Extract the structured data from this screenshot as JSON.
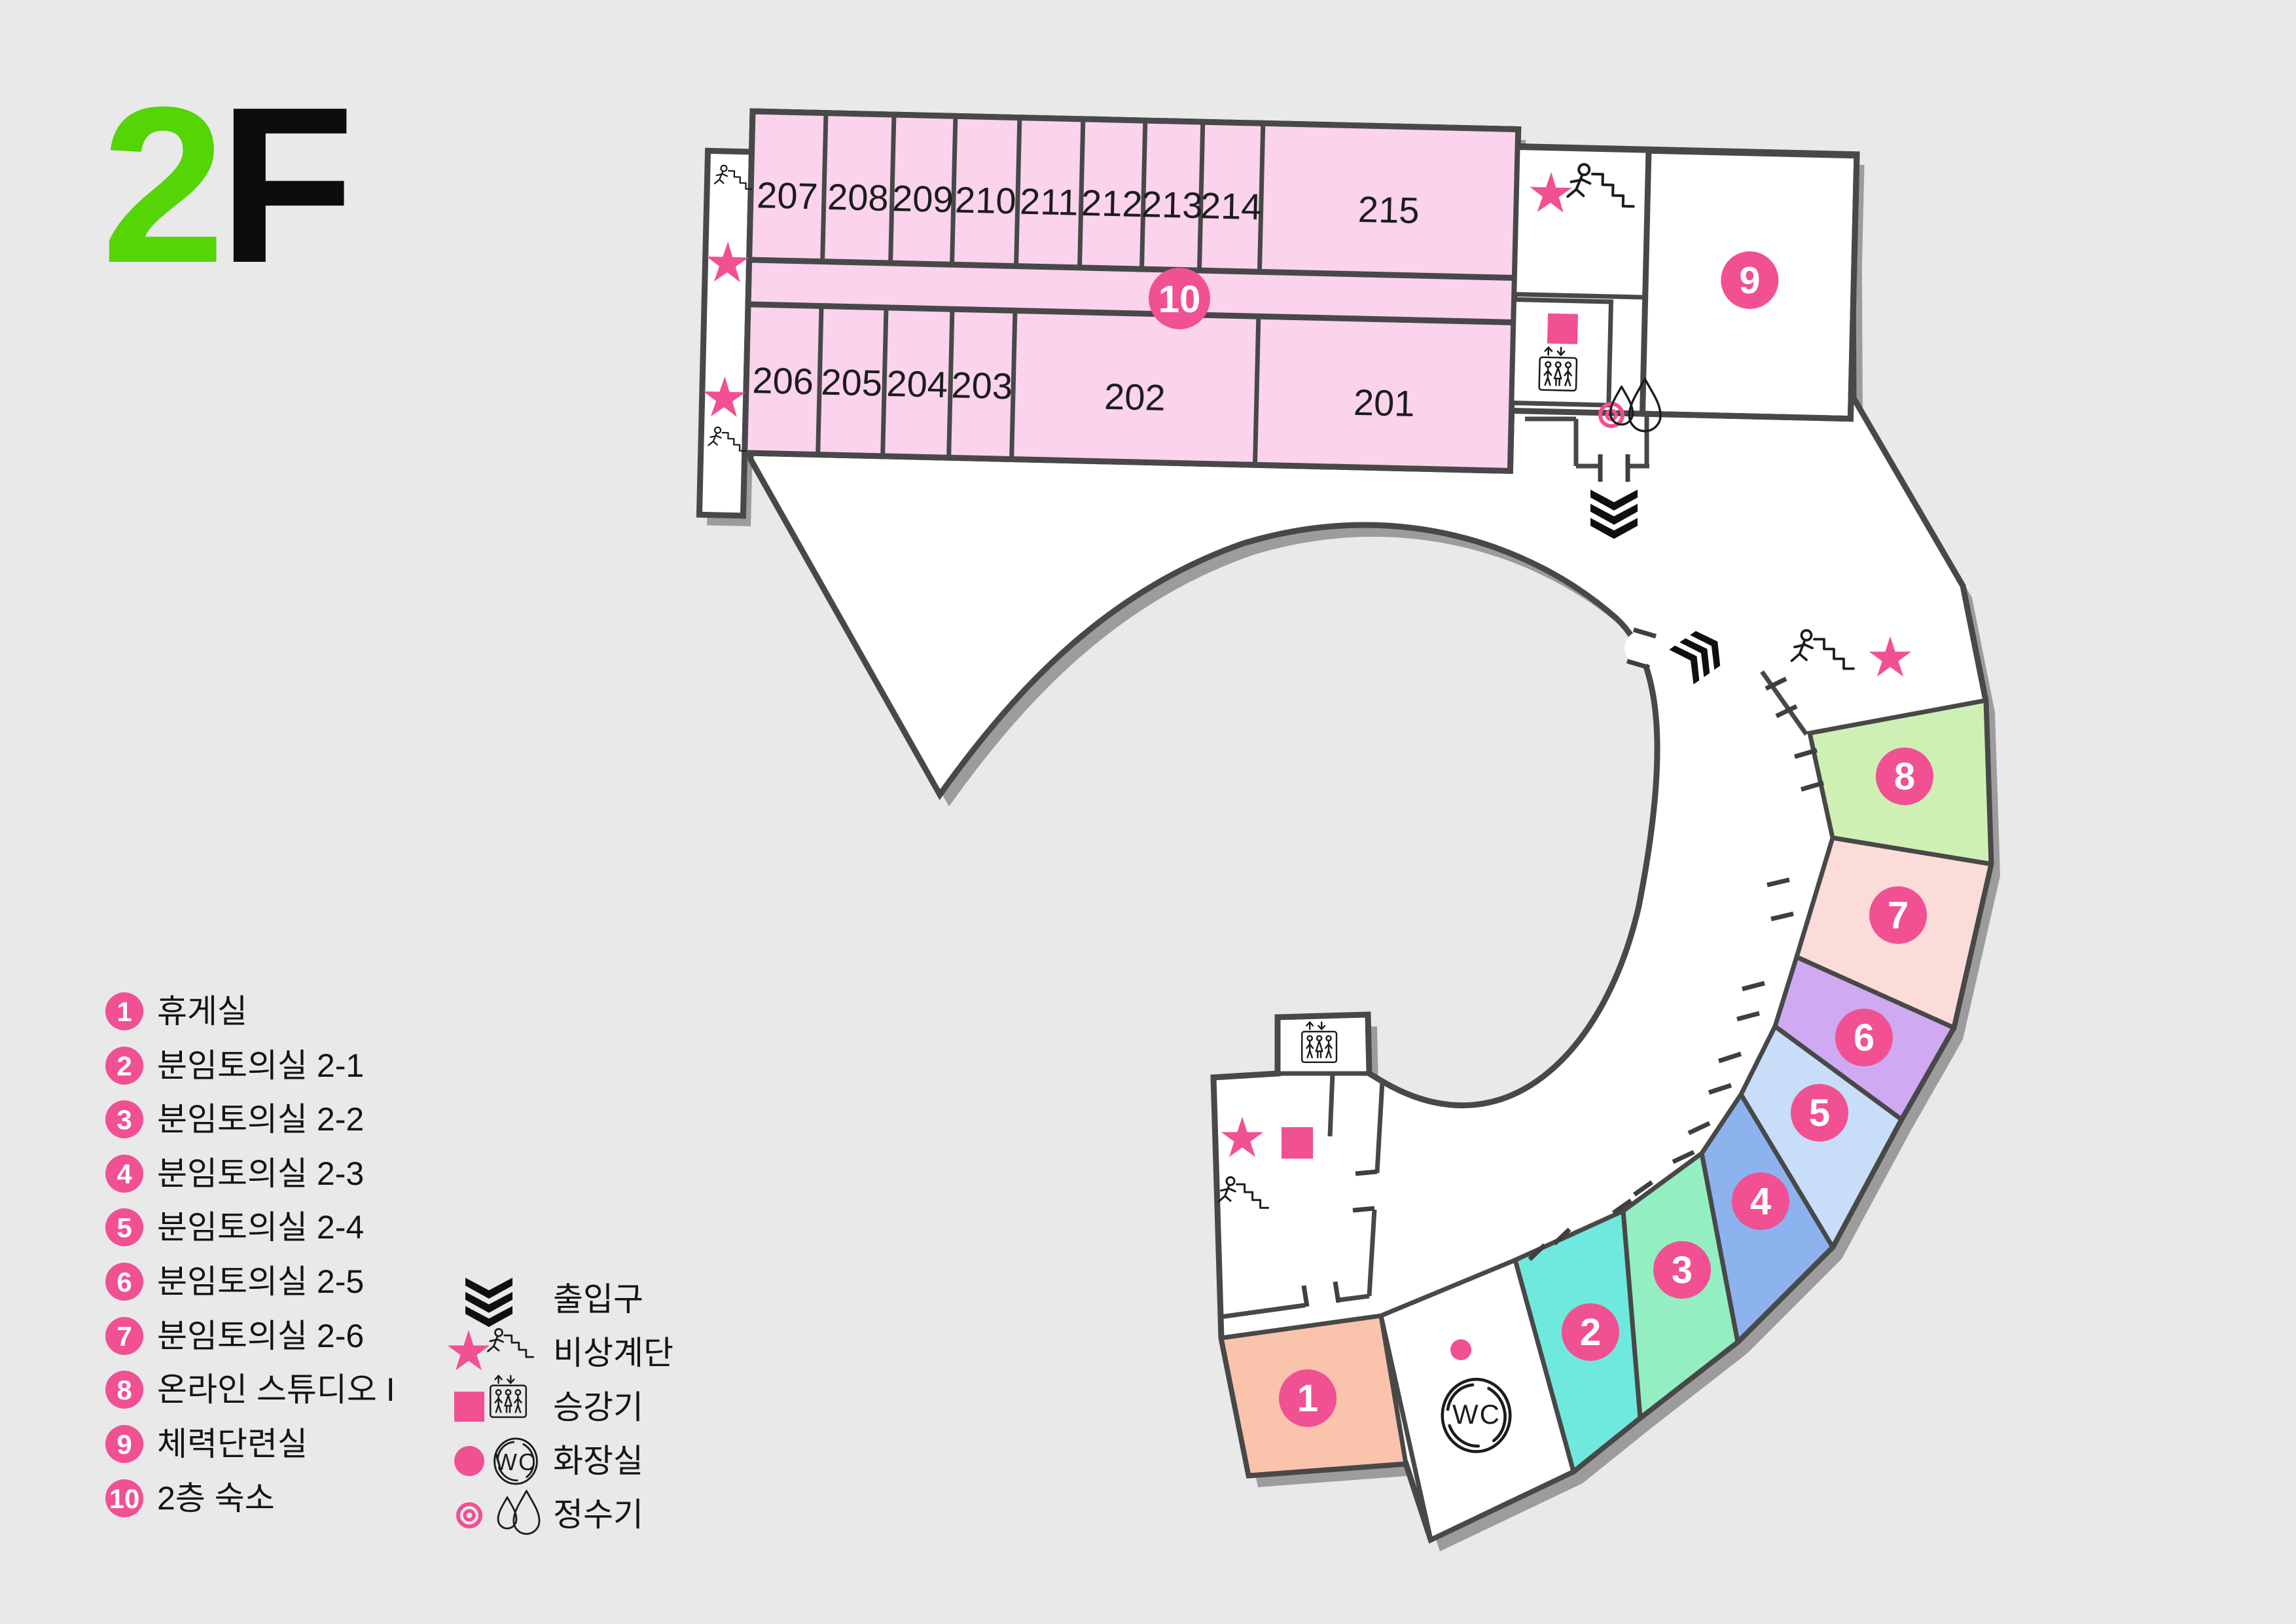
{
  "title": {
    "floor_digit": "2",
    "floor_letter": "F"
  },
  "map": {
    "top_rooms": [
      "207",
      "208",
      "209",
      "210",
      "211",
      "212",
      "213",
      "214",
      "215"
    ],
    "bottom_rooms": [
      "206",
      "205",
      "204",
      "203",
      "202",
      "201"
    ],
    "badges": [
      "1",
      "2",
      "3",
      "4",
      "5",
      "6",
      "7",
      "8",
      "9",
      "10"
    ],
    "wc_label": "WC"
  },
  "legend": {
    "items": [
      {
        "num": "1",
        "label": "휴게실"
      },
      {
        "num": "2",
        "label": "분임토의실 2-1"
      },
      {
        "num": "3",
        "label": "분임토의실 2-2"
      },
      {
        "num": "4",
        "label": "분임토의실 2-3"
      },
      {
        "num": "5",
        "label": "분임토의실 2-4"
      },
      {
        "num": "6",
        "label": "분임토의실 2-5"
      },
      {
        "num": "7",
        "label": "분임토의실 2-6"
      },
      {
        "num": "8",
        "label": "온라인 스튜디오 I"
      },
      {
        "num": "9",
        "label": "체력단련실"
      },
      {
        "num": "10",
        "label": "2층 숙소"
      }
    ],
    "icons": [
      {
        "icon": "entrance-chevrons-icon",
        "label": "출입구"
      },
      {
        "icon": "emergency-stairs-icon",
        "label": "비상계단"
      },
      {
        "icon": "elevator-icon",
        "label": "승강기"
      },
      {
        "icon": "restroom-wc-icon",
        "label": "화장실"
      },
      {
        "icon": "water-purifier-icon",
        "label": "정수기"
      }
    ]
  },
  "colors": {
    "bg": "#e9e9e9",
    "wall": "#484848",
    "shadow": "#9c9c9c",
    "accent": "#f15092",
    "title_green": "#55d406",
    "room_pink": "#fbd3ed",
    "room1": "#f9c3ac",
    "room2": "#6fe9dd",
    "room3": "#93efc2",
    "room4": "#8cb3ee",
    "room5": "#c7ddf8",
    "room6": "#cfa9f2",
    "room7": "#fcdcd8",
    "room8": "#cff0b5",
    "room9": "#a9edd9"
  }
}
